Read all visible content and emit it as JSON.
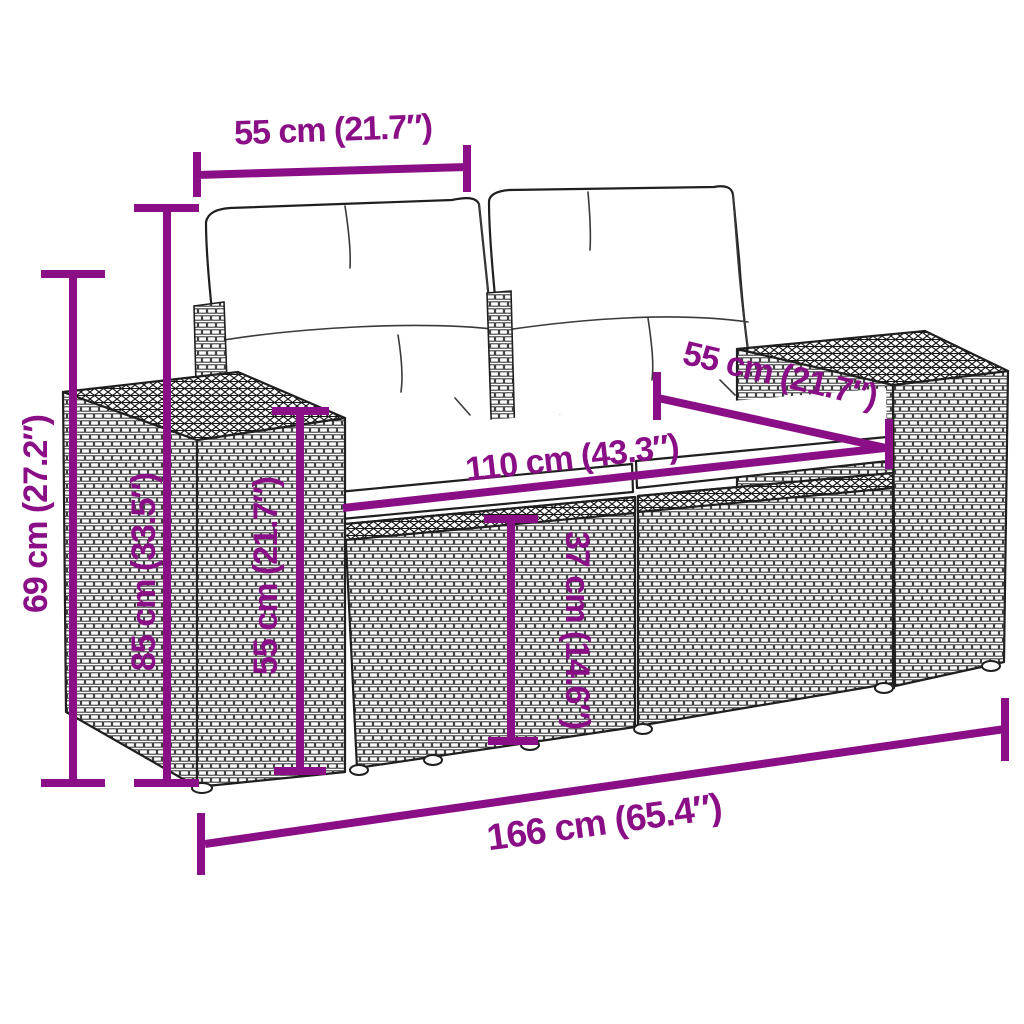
{
  "diagram": {
    "subject": "rattan garden loveseat with cushions - dimension drawing",
    "accent_color": "#8a0e86",
    "line_color": "#1f1f1f",
    "background_color": "#ffffff",
    "dimensions": {
      "cushion_width": "55 cm (21.7″)",
      "backrest_height": "69 cm (27.2″)",
      "total_height": "85 cm (33.5″)",
      "armrest_height": "55 cm (21.7″)",
      "seat_width": "110 cm (43.3″)",
      "seat_depth": "55 cm (21.7″)",
      "seat_height": "37 cm (14.6″)",
      "total_width": "166 cm (65.4″)"
    }
  }
}
